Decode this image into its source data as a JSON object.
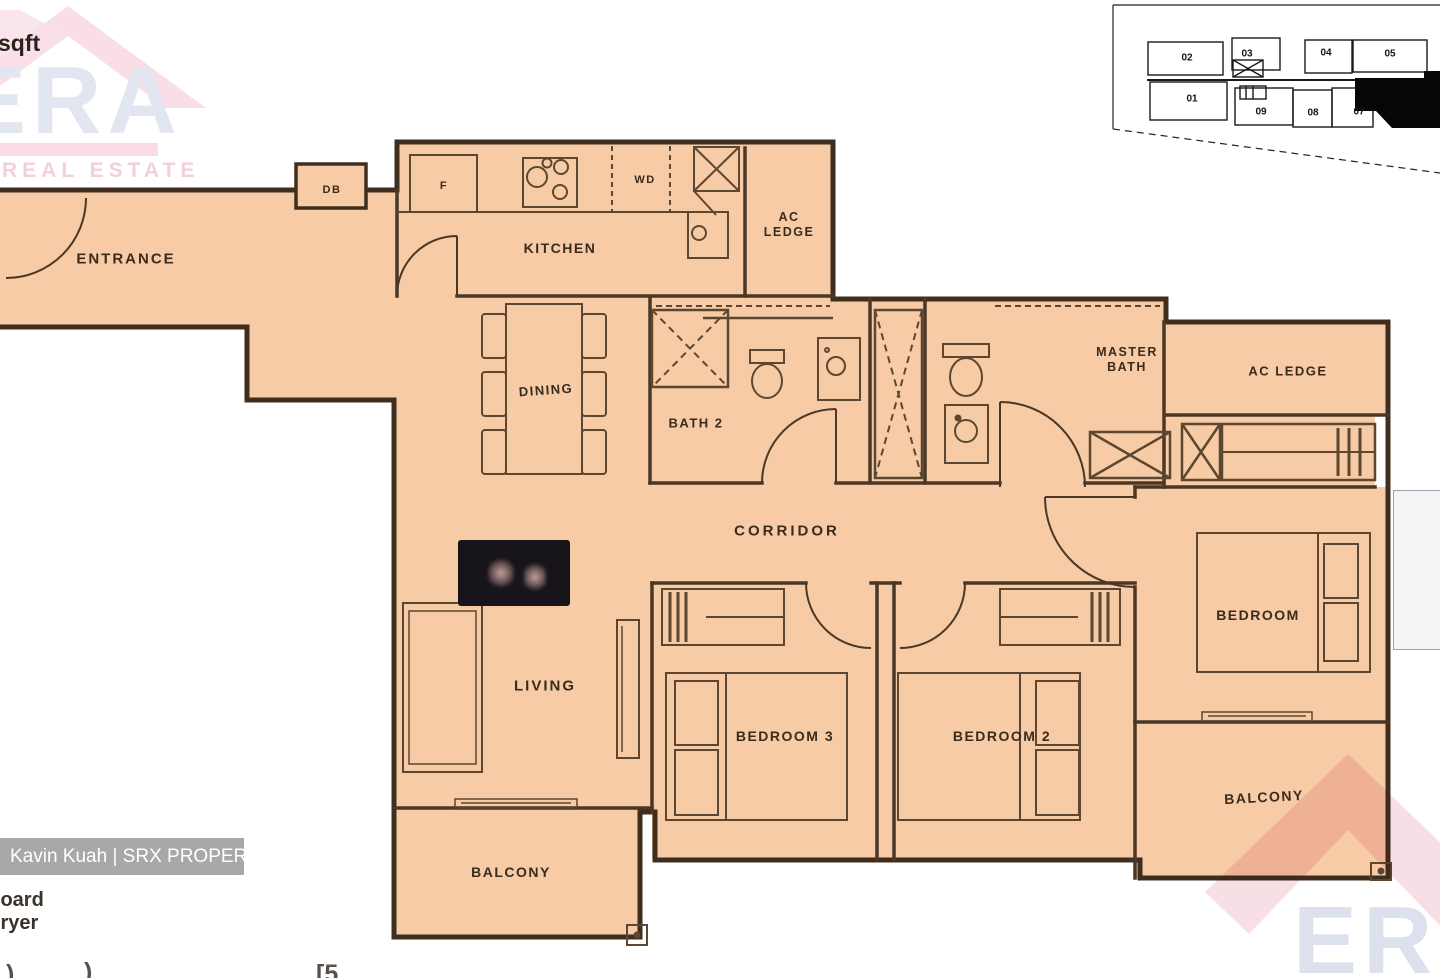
{
  "plan": {
    "rooms": {
      "entrance": "ENTRANCE",
      "kitchen": "KITCHEN",
      "dining": "DINING",
      "bath2": "BATH 2",
      "master_bath_l1": "MASTER",
      "master_bath_l2": "BATH",
      "ac_ledge_top_l1": "AC",
      "ac_ledge_top_l2": "LEDGE",
      "ac_ledge_right": "AC LEDGE",
      "corridor": "CORRIDOR",
      "living": "LIVING",
      "bedroom3": "BEDROOM 3",
      "bedroom2": "BEDROOM 2",
      "bedroom": "BEDROOM",
      "balcony_living": "BALCONY",
      "balcony_master": "BALCONY"
    },
    "fixtures": {
      "db": "DB",
      "fridge": "F",
      "washer_dryer": "WD"
    }
  },
  "key_plan": {
    "units": [
      "02",
      "03",
      "04",
      "05",
      "01",
      "09",
      "08",
      "07"
    ]
  },
  "watermarks": {
    "area_unit_partial": "sqft",
    "era_brand": "ERA",
    "era_tagline": "REAL ESTATE",
    "agent_badge": "Kavin Kuah | SRX PROPERTY",
    "legend_line1": "Board",
    "legend_line2": "Dryer",
    "edge_fragment1": ")",
    "edge_fragment2": ")",
    "edge_fragment3": "[5"
  },
  "colors": {
    "floor": "#f6cba6",
    "wall_dark": "#3f2e1e",
    "wall_inner": "#4a3726",
    "fixture_line": "#5d4730",
    "era_pink": "#f8dce5",
    "era_blue": "#e2e6f1",
    "badge_bg": "#a8a8a8",
    "highlighted_unit": "#060606",
    "stamp_bg": "#18141b"
  }
}
